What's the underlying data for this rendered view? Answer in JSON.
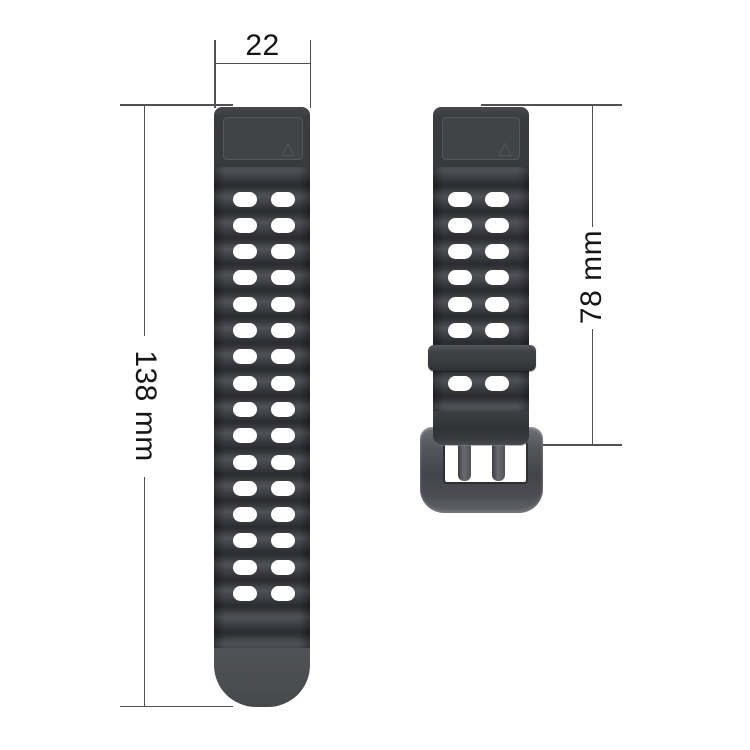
{
  "page": {
    "background": "#ffffff"
  },
  "annotations": {
    "top_width": {
      "label": "22"
    },
    "left_length": {
      "label": "138 mm"
    },
    "right_length": {
      "label": "78 mm"
    }
  },
  "icons": {
    "triangle_mark": "△"
  },
  "colors": {
    "dimension_line": "#515154",
    "dimension_text": "#161616",
    "strap_base": "#3a3b3e",
    "wave_light": "#505156",
    "wave_dark": "#2b2c30",
    "strap_tip": "#4c4d51",
    "hole": "#ffffff",
    "keeper": "#3f4044",
    "buckle": "#54555a"
  },
  "left_strap": {
    "hole_rows": 16,
    "hole_columns": 2
  },
  "right_strap": {
    "hole_rows_above_keeper": 6,
    "hole_rows_below_keeper": 1,
    "hole_columns": 2
  }
}
